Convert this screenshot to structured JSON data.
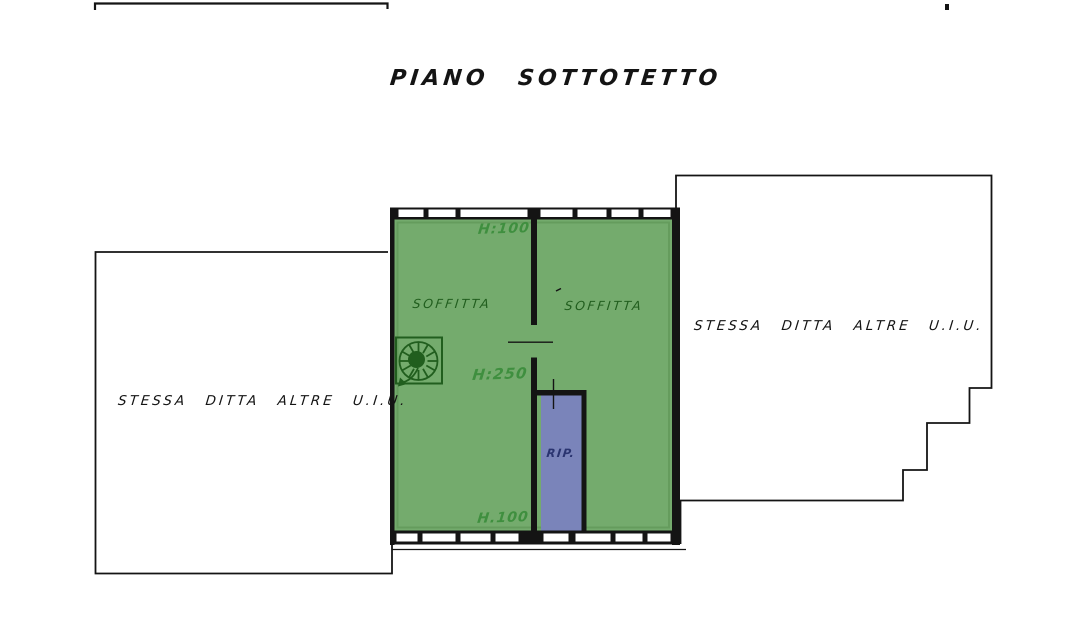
{
  "title": "PIANO SOTTOTETTO",
  "rooms": {
    "soffitta_left": {
      "label": "SOFFITTA"
    },
    "soffitta_right": {
      "label": "SOFFITTA"
    },
    "storage": {
      "label": "RIP."
    }
  },
  "height_notes": {
    "top": "H:100",
    "middle": "H:250",
    "bottom": "H.100"
  },
  "adjacent_units": {
    "left": "STESSA DITTA ALTRE U.I.U.",
    "right": "STESSA DITTA ALTRE U.I.U."
  },
  "icons": {
    "staircase": "spiral-staircase-icon"
  },
  "colors": {
    "room_fill": "#74ab6d",
    "room_fill_edge": "#5f9657",
    "storage_fill": "#7a84ba",
    "ink": "#141414",
    "green_ink": "#3f8f3f",
    "dark_green_ink": "#215e1e",
    "navy_ink": "#2a3470"
  }
}
